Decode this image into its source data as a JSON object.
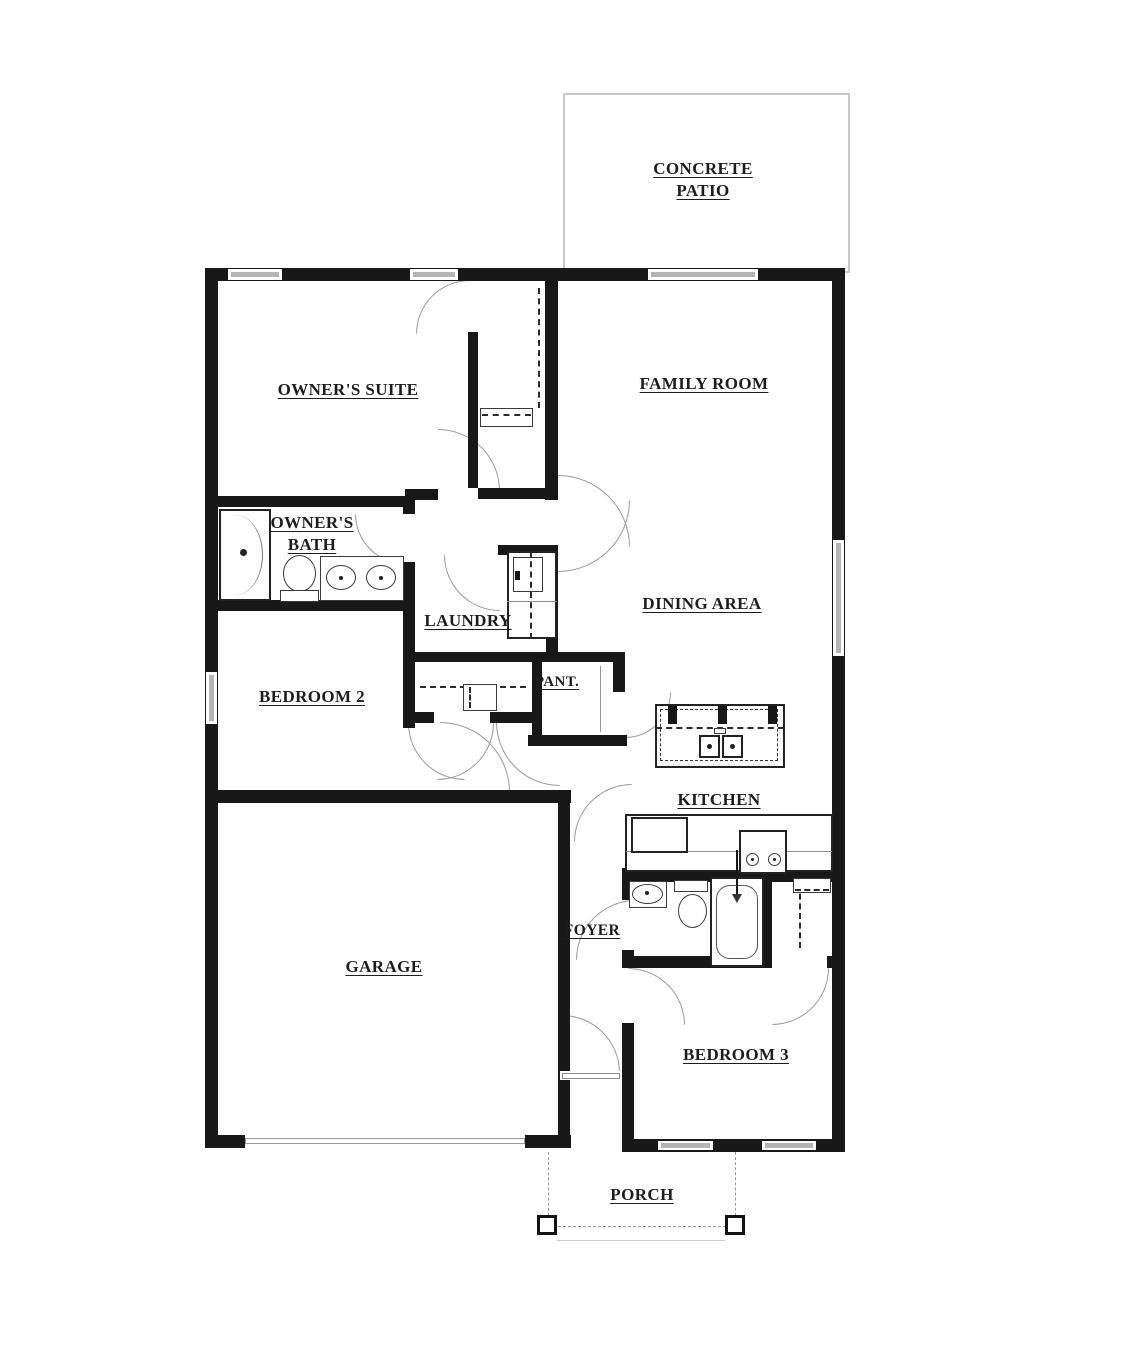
{
  "plan_title": "Single-story house floor plan",
  "rooms": [
    {
      "id": "concrete-patio",
      "label": "CONCRETE PATIO"
    },
    {
      "id": "owners-suite",
      "label": "OWNER'S SUITE"
    },
    {
      "id": "family-room",
      "label": "FAMILY ROOM"
    },
    {
      "id": "owners-bath",
      "label": "OWNER'S BATH"
    },
    {
      "id": "laundry",
      "label": "LAUNDRY"
    },
    {
      "id": "dining-area",
      "label": "DINING AREA"
    },
    {
      "id": "bedroom-2",
      "label": "BEDROOM 2"
    },
    {
      "id": "pantry",
      "label": "PANT."
    },
    {
      "id": "kitchen",
      "label": "KITCHEN"
    },
    {
      "id": "foyer",
      "label": "FOYER"
    },
    {
      "id": "garage",
      "label": "GARAGE"
    },
    {
      "id": "bedroom-3",
      "label": "BEDROOM 3"
    },
    {
      "id": "porch",
      "label": "PORCH"
    }
  ],
  "fixtures": [
    "shower",
    "toilet",
    "double-sink-vanity",
    "washer-dryer",
    "walk-in-closet-rod",
    "closet-shelf",
    "kitchen-island-double-sink",
    "breakfast-bar-stools",
    "refrigerator",
    "range-stove",
    "kitchen-counter",
    "pedestal-sink",
    "bathtub",
    "porch-posts",
    "windows",
    "door-swing-arcs",
    "garage-door"
  ],
  "colors": {
    "background": "#ffffff",
    "wall": "#181818",
    "window_glass": "#b5b5b5",
    "patio_outline": "#c8c8c8",
    "door_arc": "#9a9a9a",
    "label_text": "#1d1d1d"
  }
}
